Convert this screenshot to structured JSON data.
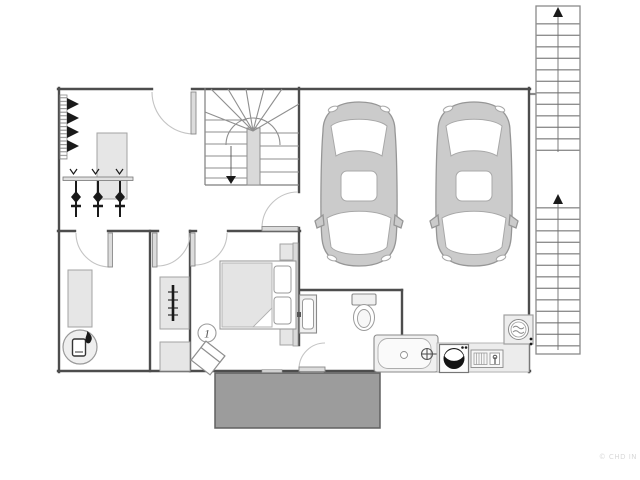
{
  "title": "single-storey floor plan with double garage",
  "labels": {
    "room_number": "1",
    "watermark": "© CHD IN"
  },
  "colors": {
    "wall": "#4d4d4d",
    "wall-thin": "#7d7d7d",
    "furn-fill": "#e6e6e6",
    "furn-stroke": "#a3a3a3",
    "fixture-fill": "#f0f0f0",
    "car-fill": "#cbcbcb",
    "car-stroke": "#969696",
    "arc": "#c4c4c4",
    "tread": "#8f8f8f",
    "black": "#1a1a1a",
    "patio-fill": "#9c9c9c",
    "patio-stroke": "#606060",
    "watermark": "#d9d9d9"
  },
  "fixtures": [
    "shoe-rack",
    "coat-rack",
    "sideboard",
    "winder-staircase",
    "entry-door",
    "storage-shelf",
    "gas-boiler",
    "wardrobe-rail",
    "cabinet",
    "double-bed",
    "nightstands",
    "armchair",
    "washbasin",
    "toilet",
    "bathtub",
    "washing-machine",
    "laundry-sink",
    "water-heater",
    "car",
    "car",
    "external-staircase",
    "terrace"
  ]
}
